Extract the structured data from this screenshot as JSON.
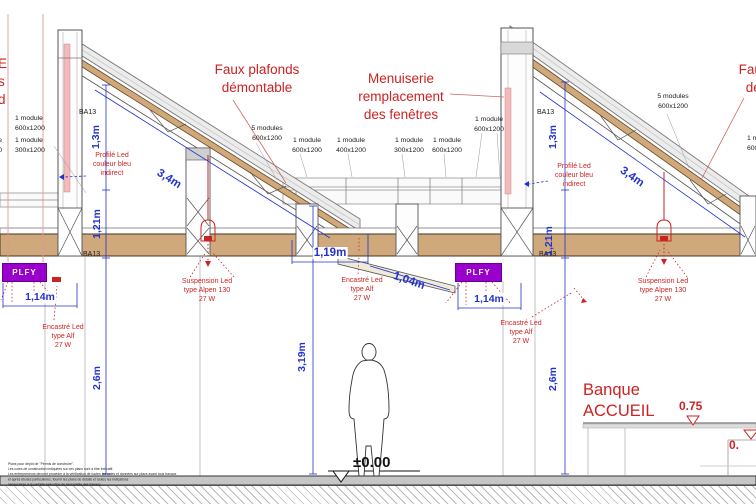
{
  "annotations": {
    "faux_plafonds": "Faux plafonds\ndémontable",
    "menuiserie": "Menuiserie\nremplacement\ndes fenêtres",
    "profile_led": "Profilé Led\ncouleur bleu\nindirect",
    "suspension_led": "Suspension Led\ntype Alpen 130\n27 W",
    "encastre_led": "Encastré Led\ntype Alf\n27 W",
    "banque_accueil": "Banque\nACCUEIL"
  },
  "module_labels": {
    "five_600": "5 modules\n600x1200",
    "one_600": "1 module\n600x1200",
    "one_400": "1 module\n400x1200",
    "one_300": "1 module\n300x1200",
    "ba13": "BA13",
    "edge_left_fragment": "E\ns\nd",
    "edge_left_module_fragment": "le\n00"
  },
  "dimensions": {
    "h1_3": "1,3m",
    "h1_21": "1,21m",
    "s3_4": "3,4m",
    "w1_14": "1,14m",
    "w1_19": "1,19m",
    "s1_04": "1,04m",
    "h2_6": "2,6m",
    "h3_19": "3,19m"
  },
  "levels": {
    "ground": "±0.00",
    "counter": "0.75",
    "counter_right": "0."
  },
  "equipment": {
    "plfy": "PLFY"
  },
  "notes": {
    "text": "Plans pour dépôt de \"Permis de construire\".\nLes cotes de construction indiquées sur ces plans sont à titre indicatif.\nLes entrepreneurs devront procéder à la vérification de toutes les cotes et données sur place avant tous travaux\net après études particulières, fournir les plans de détails et toutes les indications\nnécessaires à la parfaite exécution de l'ensemble des travaux."
  },
  "colors": {
    "annotation_red": "#cc2222",
    "dimension_blue": "#2233cc",
    "wood_tan": "#cfa87b",
    "plfy_purple": "#9900cc"
  }
}
